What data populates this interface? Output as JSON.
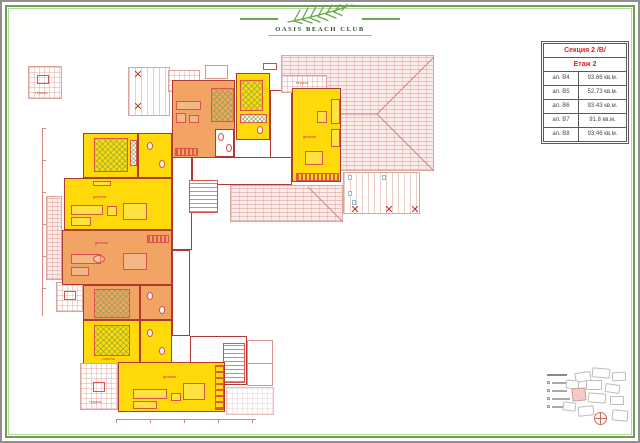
{
  "logo": {
    "text": "OASIS BEACH CLUB"
  },
  "info_table": {
    "section": "Секция 2 /В/",
    "floor": "Етаж 2",
    "rows": [
      {
        "apt": "ап. В4",
        "area": "93.66 кв.м."
      },
      {
        "apt": "ап. В5",
        "area": "52.73 кв.м."
      },
      {
        "apt": "ап. В6",
        "area": "93.43 кв.м."
      },
      {
        "apt": "ап. В7",
        "area": "91.8 кв.м."
      },
      {
        "apt": "ап. В8",
        "area": "93.46 кв.м."
      }
    ]
  },
  "plan": {
    "labels": {
      "living": "дневна",
      "bedroom": "спалня",
      "terrace": "тераса"
    }
  },
  "colors": {
    "yellow": "#ffd90a",
    "orange": "#f1a464",
    "wall": "#b03a33",
    "furn": "#d9534f",
    "green": "#69a74e",
    "tablered": "#cc2a26",
    "dim": "#d98880",
    "blue": "#8bbfd8",
    "pinkblob": "#f2cdc6"
  }
}
